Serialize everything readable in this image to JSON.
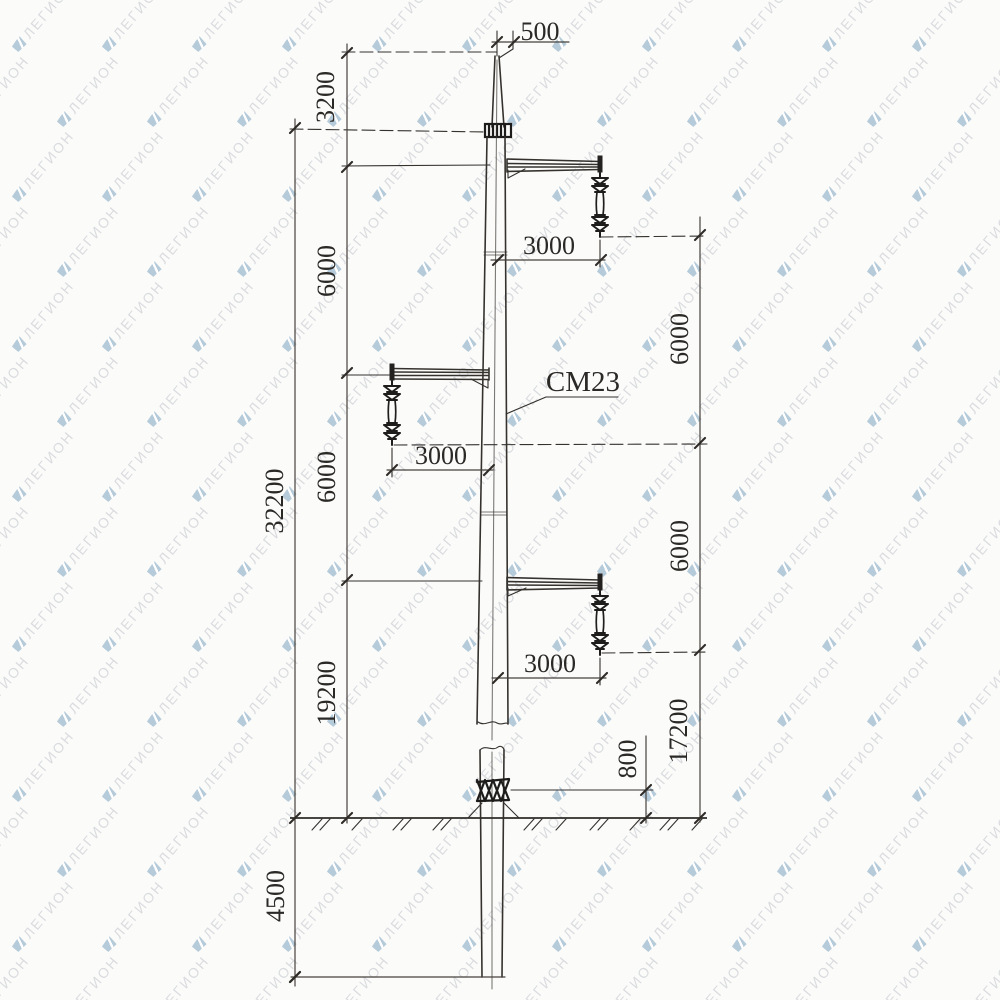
{
  "watermark": {
    "text": "ЛЕГИОН",
    "icon": "legion-flag-icon"
  },
  "drawing": {
    "pole_type_label": "СМ23",
    "dimensions": {
      "top_offset": "500",
      "tip_to_top_crossarm": "3200",
      "left_spacing_1": "6000",
      "left_spacing_2": "6000",
      "lower_crossarm_to_ground": "19200",
      "overall_above_ground": "32200",
      "embedment_depth": "4500",
      "right_spacing_1": "6000",
      "right_spacing_2": "6000",
      "lower_insulator_to_ground": "17200",
      "collar_above_ground": "800",
      "crossarm_length_top": "3000",
      "crossarm_length_middle": "3000",
      "crossarm_length_bottom": "3000"
    }
  },
  "colors": {
    "paper": "#fbfbfa",
    "drawing_line": "#35322e",
    "dimension_text": "#2b2926",
    "watermark_text": "#c5c8ce",
    "watermark_icon": "#a5bfd1"
  }
}
